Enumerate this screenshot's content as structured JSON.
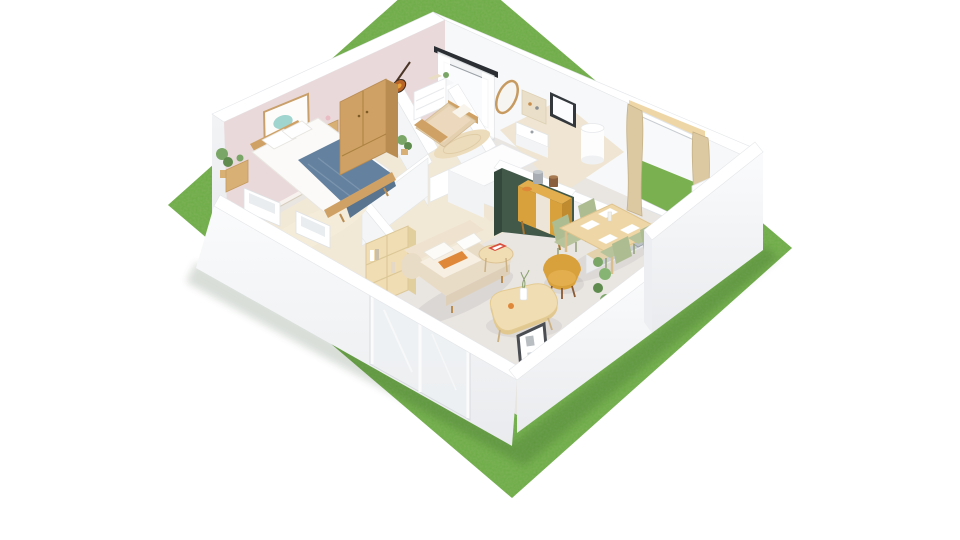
{
  "scene": {
    "title": "3D cutaway floor plan of a one-bedroom apartment on a lawn",
    "view": "isometric-birdseye",
    "environment": {
      "background": "#ffffff",
      "ground": "grass-lawn"
    },
    "rooms": [
      {
        "name": "bedroom",
        "objects": [
          "double-bed",
          "blue-throw-blanket",
          "wardrobe",
          "wall-art",
          "nightstand",
          "floor-plant",
          "stool",
          "rug",
          "two-windows"
        ]
      },
      {
        "name": "kids-room",
        "objects": [
          "single-bed",
          "white-dresser",
          "wall-guitar",
          "round-rug",
          "plant",
          "curtained-window"
        ]
      },
      {
        "name": "bathroom",
        "objects": [
          "oval-mirror",
          "wall-niche",
          "washbasin",
          "small-window",
          "water-heater"
        ]
      },
      {
        "name": "kitchen",
        "objects": [
          "island-with-green-panel",
          "counter",
          "induction-cooktop",
          "steel-sink",
          "tall-cabinet",
          "patio-door-with-curtains"
        ]
      },
      {
        "name": "dining",
        "objects": [
          "wood-table",
          "four-sage-chairs",
          "mustard-sideboard",
          "table-settings"
        ]
      },
      {
        "name": "living-room",
        "objects": [
          "cream-sofa",
          "orange-cushion",
          "mustard-armchair",
          "coffee-table",
          "cube-bookshelf",
          "side-table-with-magazine",
          "leaning-poster",
          "climbing-plant",
          "sliding-glass-door"
        ]
      }
    ]
  },
  "colors": {
    "background": "#ffffff",
    "grass_base": "#6cab45",
    "grass_light": "#7ab04f",
    "wall_white": "#ffffff",
    "wall_face": "#f3f4f6",
    "wall_shade": "#e7e9ec",
    "wall_edge": "#dfe2e5",
    "wall_inner_pink": "#ead9da",
    "floor_living": "#e9e5e1",
    "floor_warm": "#f2e8d6",
    "floor_bath": "#efe5d2",
    "partition_green": "#42594a",
    "partition_green_dark": "#35483c",
    "wood": "#cfa164",
    "wood_dark": "#b98d52",
    "wood_light": "#eed6a6",
    "wood_pale": "#f0ddb4",
    "mustard": "#d9a13b",
    "mustard_light": "#e2ae4e",
    "mustard_dark": "#c08a2e",
    "sofa_cream": "#e9dcc6",
    "sofa_light": "#f6efe2",
    "cushion_orange": "#e0883a",
    "blanket_blue": "#64819f",
    "blanket_blue_dark": "#58748f",
    "sage": "#b6c39b",
    "sage_dark": "#a3b185",
    "steel": "#c6ccd2",
    "cooktop_black": "#232733",
    "plant_green": "#7aa667",
    "plant_dark": "#5f8c4e",
    "curtain_beige": "#dcc9a2",
    "magazine_red": "#d94f3d",
    "poster_frame": "#4a4d52",
    "mirror_wood": "#c79a5f",
    "heater_white": "#fdfdfe",
    "glass_tint": "#eef1f3"
  }
}
